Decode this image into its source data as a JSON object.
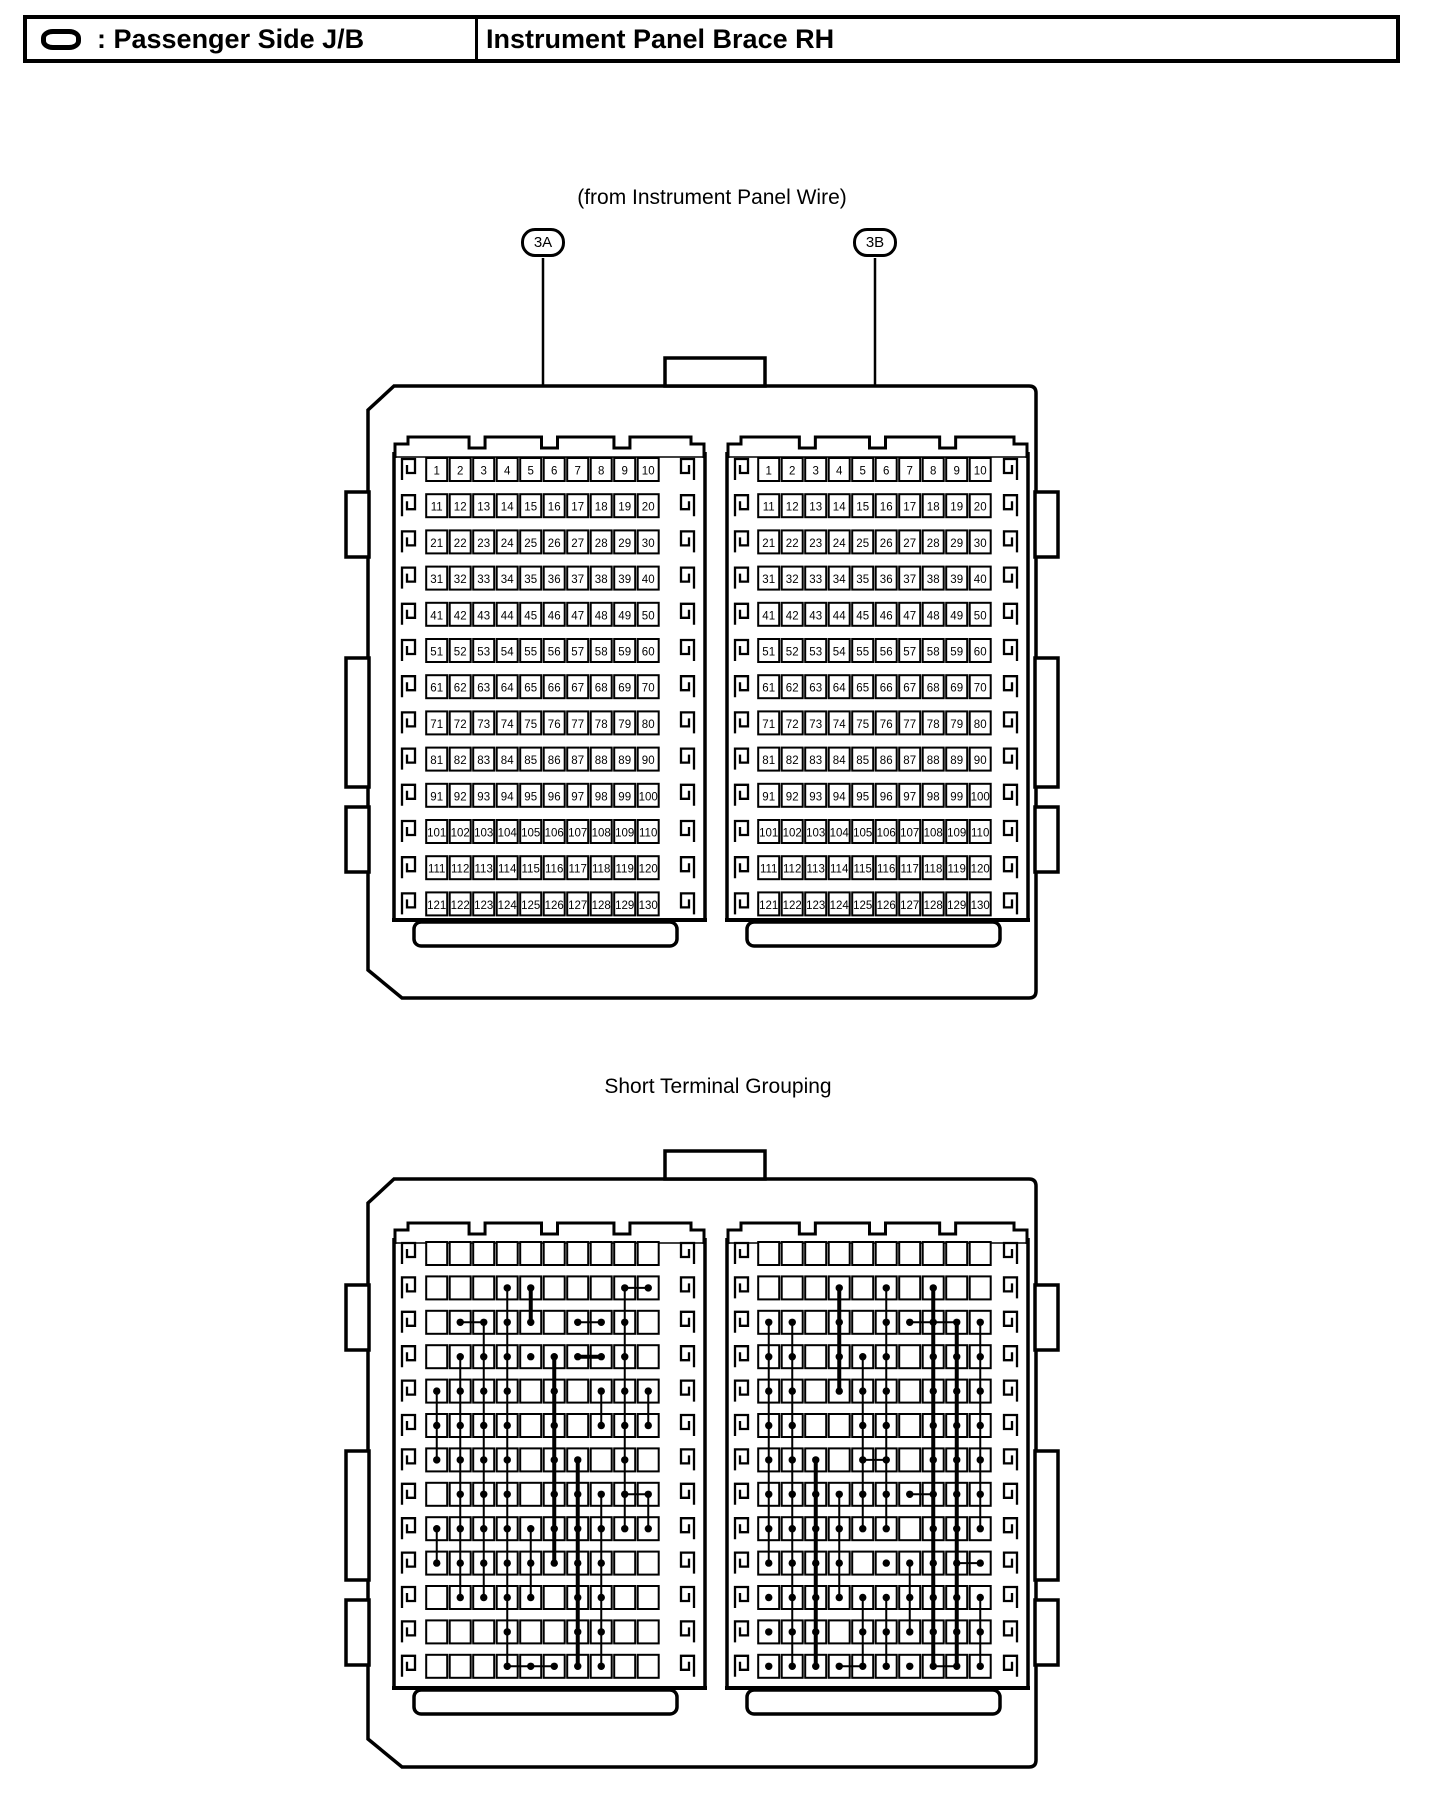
{
  "header": {
    "legend_icon": "oval-connector-icon",
    "legend_label": ": Passenger Side J/B",
    "title": "Instrument Panel Brace RH"
  },
  "figure": {
    "caption_top": "(from Instrument Panel Wire)",
    "connector_a": "3A",
    "connector_b": "3B",
    "section2_title": "Short Terminal Grouping",
    "grid": {
      "rows": 13,
      "cols": 10
    },
    "pin_rows": [
      [
        1,
        2,
        3,
        4,
        5,
        6,
        7,
        8,
        9,
        10
      ],
      [
        11,
        12,
        13,
        14,
        15,
        16,
        17,
        18,
        19,
        20
      ],
      [
        21,
        22,
        23,
        24,
        25,
        26,
        27,
        28,
        29,
        30
      ],
      [
        31,
        32,
        33,
        34,
        35,
        36,
        37,
        38,
        39,
        40
      ],
      [
        41,
        42,
        43,
        44,
        45,
        46,
        47,
        48,
        49,
        50
      ],
      [
        51,
        52,
        53,
        54,
        55,
        56,
        57,
        58,
        59,
        60
      ],
      [
        61,
        62,
        63,
        64,
        65,
        66,
        67,
        68,
        69,
        70
      ],
      [
        71,
        72,
        73,
        74,
        75,
        76,
        77,
        78,
        79,
        80
      ],
      [
        81,
        82,
        83,
        84,
        85,
        86,
        87,
        88,
        89,
        90
      ],
      [
        91,
        92,
        93,
        94,
        95,
        96,
        97,
        98,
        99,
        100
      ],
      [
        101,
        102,
        103,
        104,
        105,
        106,
        107,
        108,
        109,
        110
      ],
      [
        111,
        112,
        113,
        114,
        115,
        116,
        117,
        118,
        119,
        120
      ],
      [
        121,
        122,
        123,
        124,
        125,
        126,
        127,
        128,
        129,
        130
      ]
    ],
    "short_groups": {
      "left": {
        "dots": [
          [
            2,
            [
              4,
              5,
              9,
              10
            ]
          ],
          [
            3,
            [
              2,
              3,
              4,
              5,
              7,
              8,
              9
            ]
          ],
          [
            4,
            [
              2,
              3,
              4,
              5,
              6,
              7,
              8,
              9
            ]
          ],
          [
            5,
            [
              1,
              2,
              3,
              4,
              6,
              8,
              9,
              10
            ]
          ],
          [
            6,
            [
              1,
              2,
              3,
              4,
              6,
              8,
              9,
              10
            ]
          ],
          [
            7,
            [
              1,
              2,
              3,
              4,
              6,
              7,
              9
            ]
          ],
          [
            8,
            [
              2,
              3,
              4,
              6,
              7,
              8,
              9,
              10
            ]
          ],
          [
            9,
            [
              1,
              2,
              3,
              4,
              5,
              6,
              7,
              8,
              9,
              10
            ]
          ],
          [
            10,
            [
              1,
              2,
              3,
              4,
              5,
              6,
              7,
              8
            ]
          ],
          [
            11,
            [
              2,
              3,
              4,
              5,
              7,
              8
            ]
          ],
          [
            12,
            [
              4,
              7,
              8
            ]
          ],
          [
            13,
            [
              4,
              5,
              6,
              7,
              8
            ]
          ]
        ],
        "vlines": [
          [
            1,
            5,
            7,
            2
          ],
          [
            1,
            9,
            10,
            2
          ],
          [
            2,
            4,
            11,
            2
          ],
          [
            3,
            3,
            11,
            2
          ],
          [
            4,
            2,
            13,
            2
          ],
          [
            5,
            2,
            3,
            4
          ],
          [
            5,
            9,
            11,
            2
          ],
          [
            6,
            4,
            10,
            4
          ],
          [
            7,
            7,
            13,
            4
          ],
          [
            8,
            5,
            6,
            2
          ],
          [
            8,
            8,
            13,
            2
          ],
          [
            9,
            2,
            9,
            2
          ],
          [
            10,
            5,
            6,
            2
          ],
          [
            10,
            8,
            9,
            2
          ]
        ],
        "hlines": [
          [
            2,
            9,
            10,
            2
          ],
          [
            3,
            2,
            3,
            2
          ],
          [
            3,
            7,
            8,
            2
          ],
          [
            4,
            7,
            8,
            4
          ],
          [
            8,
            9,
            10,
            2
          ],
          [
            13,
            4,
            6,
            2
          ]
        ]
      },
      "right": {
        "dots": [
          [
            2,
            [
              4,
              6,
              8
            ]
          ],
          [
            3,
            [
              1,
              2,
              4,
              6,
              7,
              8,
              9,
              10
            ]
          ],
          [
            4,
            [
              1,
              2,
              4,
              5,
              6,
              8,
              9,
              10
            ]
          ],
          [
            5,
            [
              1,
              2,
              4,
              5,
              6,
              8,
              9,
              10
            ]
          ],
          [
            6,
            [
              1,
              2,
              5,
              6,
              8,
              9,
              10
            ]
          ],
          [
            7,
            [
              1,
              2,
              3,
              5,
              6,
              8,
              9,
              10
            ]
          ],
          [
            8,
            [
              1,
              2,
              3,
              4,
              5,
              6,
              7,
              8,
              9,
              10
            ]
          ],
          [
            9,
            [
              1,
              2,
              3,
              4,
              5,
              6,
              8,
              9,
              10
            ]
          ],
          [
            10,
            [
              1,
              2,
              3,
              4,
              6,
              7,
              8,
              9,
              10
            ]
          ],
          [
            11,
            [
              1,
              2,
              3,
              4,
              5,
              6,
              7,
              8,
              9,
              10
            ]
          ],
          [
            12,
            [
              1,
              2,
              3,
              5,
              6,
              7,
              8,
              9,
              10
            ]
          ],
          [
            13,
            [
              1,
              2,
              3,
              4,
              5,
              6,
              7,
              8,
              9,
              10
            ]
          ]
        ],
        "vlines": [
          [
            1,
            3,
            10,
            2
          ],
          [
            2,
            3,
            13,
            2
          ],
          [
            3,
            7,
            13,
            4
          ],
          [
            4,
            2,
            5,
            4
          ],
          [
            4,
            8,
            11,
            2
          ],
          [
            5,
            4,
            9,
            2
          ],
          [
            5,
            11,
            13,
            2
          ],
          [
            6,
            2,
            9,
            2
          ],
          [
            6,
            11,
            13,
            2
          ],
          [
            7,
            10,
            12,
            2
          ],
          [
            8,
            2,
            13,
            4
          ],
          [
            9,
            3,
            13,
            4
          ],
          [
            10,
            3,
            9,
            2
          ],
          [
            10,
            11,
            13,
            2
          ]
        ],
        "hlines": [
          [
            3,
            7,
            9,
            2
          ],
          [
            7,
            5,
            6,
            2
          ],
          [
            8,
            7,
            8,
            2
          ],
          [
            10,
            9,
            10,
            2
          ],
          [
            13,
            4,
            5,
            2
          ],
          [
            13,
            8,
            9,
            2
          ]
        ]
      }
    },
    "colors": {
      "ink": "#000000",
      "paper": "#ffffff"
    }
  }
}
